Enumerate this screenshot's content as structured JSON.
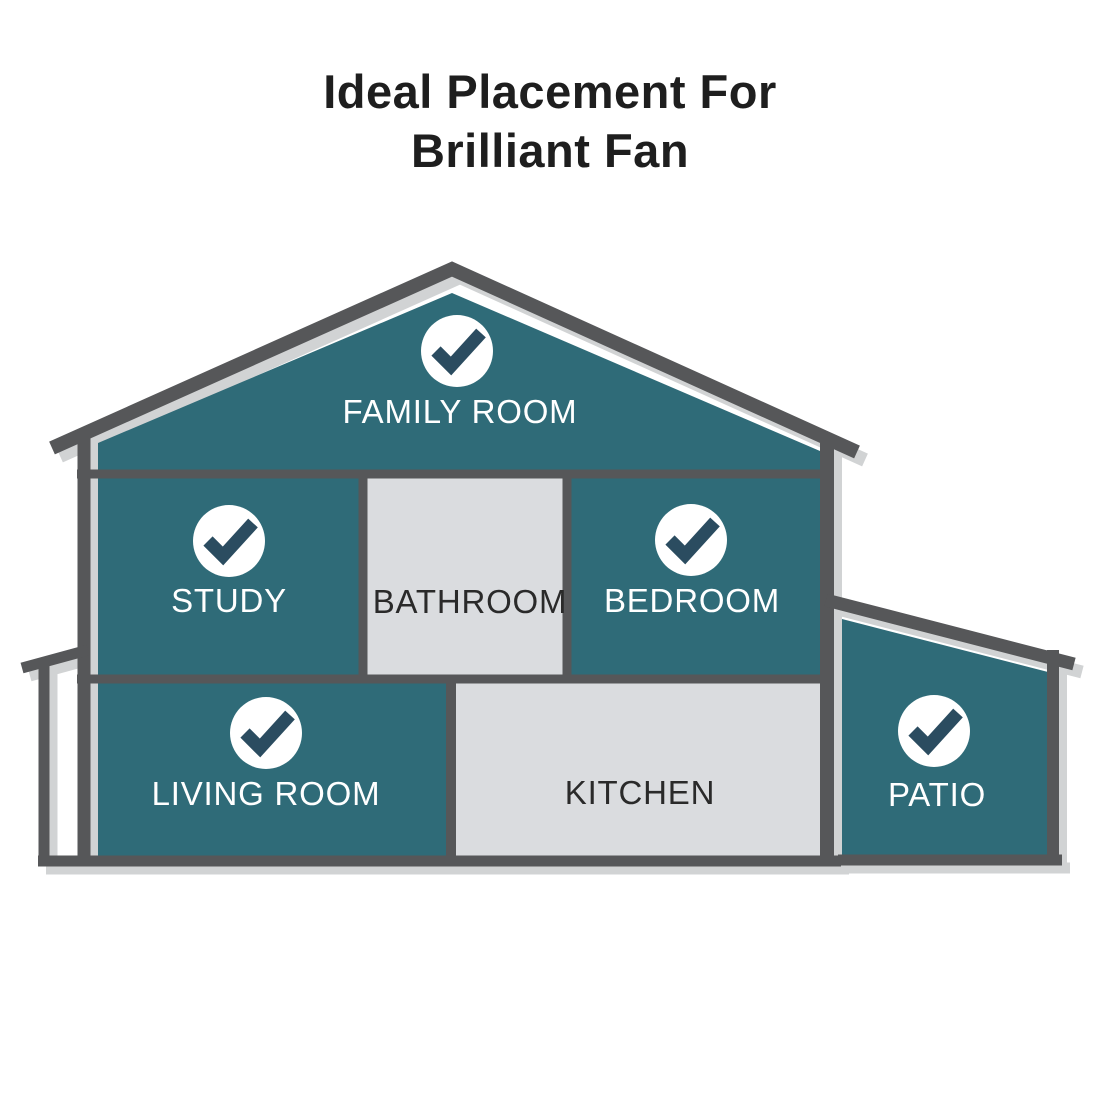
{
  "title": {
    "line1": "Ideal Placement For",
    "line2": "Brilliant Fan"
  },
  "rooms": [
    {
      "label": "FAMILY ROOM",
      "ideal": true,
      "floor": "attic"
    },
    {
      "label": "STUDY",
      "ideal": true,
      "floor": "second"
    },
    {
      "label": "BATHROOM",
      "ideal": false,
      "floor": "second"
    },
    {
      "label": "BEDROOM",
      "ideal": true,
      "floor": "second"
    },
    {
      "label": "LIVING ROOM",
      "ideal": true,
      "floor": "first"
    },
    {
      "label": "KITCHEN",
      "ideal": false,
      "floor": "first"
    },
    {
      "label": "PATIO",
      "ideal": true,
      "floor": "first"
    }
  ],
  "icons": {
    "checkmark": "✓"
  },
  "colors": {
    "background": "#FFFFFF",
    "house_teal": "#2F6B78",
    "room_gray": "#DADCDF",
    "outline_dark": "#565759",
    "outline_light": "#D1D3D4",
    "check_circle": "#FFFFFF",
    "check_mark": "#2B4C60",
    "label_on_teal": "#FFFFFF",
    "label_on_gray": "#2A2A2A",
    "title_text": "#1E1E1E"
  }
}
